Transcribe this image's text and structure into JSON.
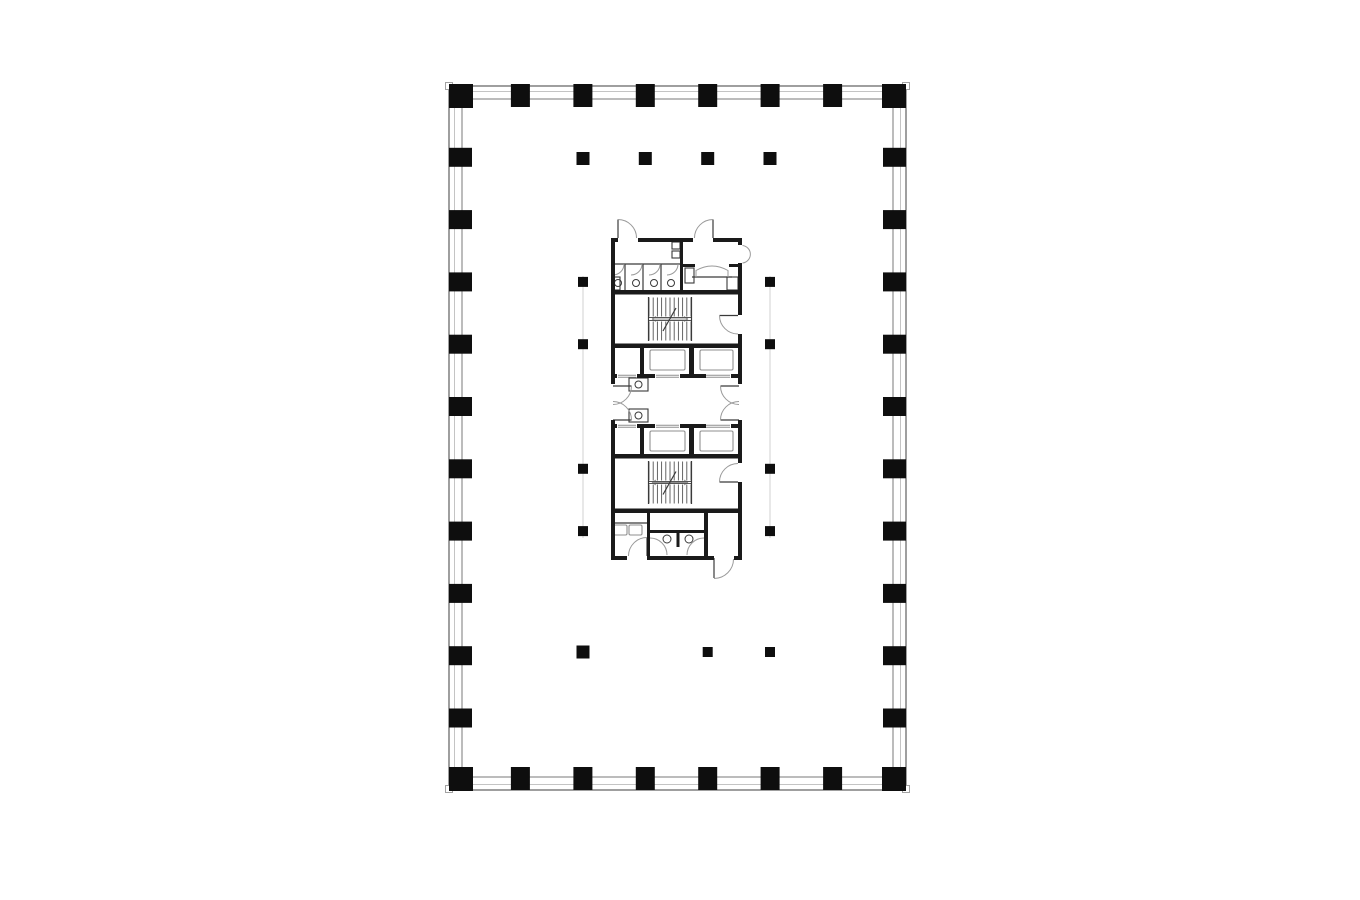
{
  "document": {
    "kind": "architectural-floor-plan",
    "description": "Typical tower floor plate: rectangular perimeter curtain wall with columns and a central service core (toilets, two stairs, four elevators, elevator lobby)",
    "text_labels": [],
    "background": "#ffffff"
  },
  "colors": {
    "ink": "#0e0e0e",
    "wall": "#1a1a1a",
    "thin": "#3a3a3a",
    "tread": "#555555",
    "light": "#8f8f8f",
    "arc": "#9a9a9a",
    "faint": "#d2d2d2",
    "band_outer": "#6b6b6b",
    "band_mid": "#c4c4c4",
    "band_inner": "#7a7a7a",
    "tick_stroke": "#999999",
    "paper": "#ffffff"
  },
  "canvas": {
    "width": 1360,
    "height": 900
  },
  "plan": {
    "band": {
      "outer": [
        449,
        86,
        457,
        704
      ],
      "mid": [
        454.5,
        91.5,
        446,
        693
      ],
      "inner": [
        462,
        99,
        431,
        678
      ]
    },
    "corner_ticks": [
      [
        445.5,
        82.5,
        7,
        7
      ],
      [
        902.5,
        82.5,
        7,
        7
      ],
      [
        445.5,
        785.5,
        7,
        7
      ],
      [
        902.5,
        785.5,
        7,
        7
      ]
    ],
    "perimeter_columns": {
      "corner_positions": [
        [
          449,
          84
        ],
        [
          882,
          84
        ],
        [
          449,
          767
        ],
        [
          882,
          767
        ]
      ],
      "corner_size": 24,
      "top_xs": [
        520.4,
        582.9,
        645.3,
        707.7,
        770.1,
        832.6
      ],
      "bottom_xs": [
        520.4,
        582.9,
        645.3,
        707.7,
        770.1,
        832.6
      ],
      "left_ys": [
        157.3,
        219.6,
        281.9,
        344.2,
        406.5,
        468.8,
        531.1,
        593.4,
        655.7,
        718
      ],
      "right_ys": [
        157.3,
        219.6,
        281.9,
        344.2,
        406.5,
        468.8,
        531.1,
        593.4,
        655.7,
        718
      ],
      "top_y": 84,
      "bottom_y": 767,
      "left_x": 449,
      "right_x": 883,
      "edge_w": 19,
      "edge_h": 23,
      "side_w": 23,
      "side_h": 19
    },
    "interior_columns": [
      [
        583,
        158.5,
        13
      ],
      [
        645.3,
        158.5,
        13
      ],
      [
        707.7,
        158.5,
        13
      ],
      [
        770,
        158.5,
        13
      ],
      [
        583,
        281.9,
        10
      ],
      [
        770,
        281.9,
        10
      ],
      [
        583,
        344.2,
        10
      ],
      [
        770,
        344.2,
        10
      ],
      [
        583,
        468.8,
        10
      ],
      [
        770,
        468.8,
        10
      ],
      [
        583,
        531.1,
        10
      ],
      [
        770,
        531.1,
        10
      ],
      [
        583,
        652,
        13
      ],
      [
        707.7,
        652,
        10
      ],
      [
        770,
        652,
        10
      ]
    ],
    "faint_lines": [
      [
        583,
        276,
        583,
        538
      ],
      [
        770,
        276,
        770,
        538
      ]
    ]
  },
  "core": {
    "wall_rects": [
      [
        611,
        238,
        7,
        4
      ],
      [
        638,
        238,
        55,
        4
      ],
      [
        713,
        238,
        29,
        4
      ],
      [
        611,
        238,
        4,
        146
      ],
      [
        611,
        420,
        4,
        140
      ],
      [
        738,
        238,
        4,
        7
      ],
      [
        738,
        263,
        4,
        52
      ],
      [
        738,
        334,
        4,
        50
      ],
      [
        738,
        420,
        4,
        43
      ],
      [
        738,
        482,
        4,
        78
      ],
      [
        680,
        238,
        3,
        53
      ],
      [
        683,
        264,
        12,
        3
      ],
      [
        729,
        264,
        9,
        3
      ],
      [
        611,
        290,
        131,
        4.5
      ],
      [
        611,
        343.5,
        131,
        4.5
      ],
      [
        640,
        348,
        4,
        26
      ],
      [
        689,
        348,
        5,
        26
      ],
      [
        611,
        374,
        6,
        4
      ],
      [
        637,
        374,
        18,
        4
      ],
      [
        680,
        374,
        26,
        4
      ],
      [
        731,
        374,
        11,
        4
      ],
      [
        611,
        424,
        6,
        4
      ],
      [
        637,
        424,
        18,
        4
      ],
      [
        680,
        424,
        26,
        4
      ],
      [
        731,
        424,
        11,
        4
      ],
      [
        640,
        428,
        4,
        26
      ],
      [
        689,
        428,
        5,
        26
      ],
      [
        611,
        454,
        131,
        4.5
      ],
      [
        611,
        508.5,
        131,
        4.5
      ],
      [
        647,
        513,
        3,
        43
      ],
      [
        704,
        513,
        4,
        43
      ],
      [
        650,
        530,
        54,
        3
      ],
      [
        676.5,
        533,
        3,
        14
      ],
      [
        611,
        556,
        16,
        4
      ],
      [
        647,
        556,
        67,
        4
      ],
      [
        734,
        556,
        8,
        4
      ]
    ],
    "thin_lines": [
      [
        611,
        264,
        680,
        264
      ],
      [
        625,
        264,
        625,
        290
      ],
      [
        643,
        264,
        643,
        290
      ],
      [
        661,
        264,
        661,
        290
      ],
      [
        648.5,
        297,
        648.5,
        341
      ],
      [
        691.5,
        297,
        691.5,
        341
      ],
      [
        648.5,
        461,
        648.5,
        504
      ],
      [
        691.5,
        461,
        691.5,
        504
      ],
      [
        611,
        523,
        647,
        523
      ],
      [
        692,
        277,
        732,
        277
      ],
      [
        663,
        331,
        676,
        308
      ],
      [
        663,
        494.5,
        676,
        471.5
      ]
    ],
    "thin_rects": [
      [
        612,
        277,
        8,
        13
      ],
      [
        672,
        242,
        8,
        7
      ],
      [
        672,
        251,
        8,
        7
      ],
      [
        727,
        277,
        11,
        13
      ],
      [
        685,
        268,
        9,
        15
      ],
      [
        629,
        378,
        19,
        13
      ],
      [
        629,
        409,
        19,
        13
      ]
    ],
    "light_rects": [
      [
        650,
        350,
        35,
        20
      ],
      [
        700,
        350,
        33,
        20
      ],
      [
        650,
        431,
        35,
        20
      ],
      [
        700,
        431,
        33,
        20
      ],
      [
        614,
        525,
        13,
        10
      ],
      [
        629,
        525,
        13,
        10
      ]
    ],
    "light_lines": [
      [
        656,
        375.3,
        679,
        375.3
      ],
      [
        656,
        377.2,
        679,
        377.2
      ],
      [
        706,
        375.3,
        730,
        375.3
      ],
      [
        706,
        377.2,
        730,
        377.2
      ],
      [
        618,
        375.3,
        636,
        375.3
      ],
      [
        618,
        377.2,
        636,
        377.2
      ],
      [
        656,
        425.3,
        679,
        425.3
      ],
      [
        656,
        427.2,
        679,
        427.2
      ],
      [
        706,
        425.3,
        730,
        425.3
      ],
      [
        706,
        427.2,
        730,
        427.2
      ],
      [
        618,
        425.3,
        636,
        425.3
      ],
      [
        618,
        427.2,
        636,
        427.2
      ],
      [
        652,
        319,
        688,
        319
      ],
      [
        652,
        319,
        656,
        316.5
      ],
      [
        652,
        319,
        656,
        321.5
      ],
      [
        688,
        319,
        684,
        316.5
      ],
      [
        688,
        319,
        684,
        321.5
      ],
      [
        652,
        482.5,
        688,
        482.5
      ],
      [
        652,
        482.5,
        656,
        480
      ],
      [
        652,
        482.5,
        656,
        485
      ],
      [
        688,
        482.5,
        684,
        480
      ],
      [
        688,
        482.5,
        684,
        485
      ]
    ],
    "door_leaves": [
      [
        618,
        238,
        618,
        219.5
      ],
      [
        713,
        238,
        713,
        219.5
      ],
      [
        738,
        315.5,
        719.5,
        315.5
      ],
      [
        613,
        386,
        631.5,
        386
      ],
      [
        613,
        420,
        631.5,
        420
      ],
      [
        739,
        386,
        720.5,
        386
      ],
      [
        739,
        420,
        720.5,
        420
      ],
      [
        738,
        482,
        719.5,
        482
      ],
      [
        647,
        556,
        647,
        537.5
      ],
      [
        714,
        558,
        714,
        578
      ]
    ],
    "door_arcs": [
      "M 618,219.5 A 18.5,18.5 0 0 1 636.5,238",
      "M 713,219.5 A 18.5,18.5 0 0 0 694.5,238",
      "M 742.5,245.5 A 8.8,8.8 0 0 1 742.5,263",
      "M 719.5,315.5 A 18.5,18.5 0 0 0 738,334",
      "M 631.5,386 A 18.5,18.5 0 0 1 613,404.5",
      "M 631.5,420 A 18.5,18.5 0 0 0 613,401.5",
      "M 720.5,386 A 18.5,18.5 0 0 0 739,404.5",
      "M 720.5,420 A 18.5,18.5 0 0 1 739,401.5",
      "M 719.5,482 A 18.5,18.5 0 0 1 738,463.5",
      "M 647,537.5 A 18.5,18.5 0 0 0 628.5,556",
      "M 714,578.5 A 19.5,19.5 0 0 0 733.5,559",
      "M 650,538 A 17,17 0 0 1 667,555",
      "M 704,538 A 17,17 0 0 0 687,555",
      "M 624,264 A 11,11 0 0 1 613,275",
      "M 642,264 A 11,11 0 0 1 631,275",
      "M 660,264 A 11,11 0 0 1 649,275",
      "M 678,264 A 11,11 0 0 1 667,275",
      "M 696,277 L 696,270.5 Q 712,261.5 728,270.5 L 728,277"
    ],
    "circles": [
      [
        618,
        283,
        3.5
      ],
      [
        636,
        283,
        3.5
      ],
      [
        654,
        283,
        3.5
      ],
      [
        671,
        283,
        3.5
      ],
      [
        638.5,
        384.5,
        3.5
      ],
      [
        638.5,
        415.5,
        3.5
      ],
      [
        667,
        539,
        4
      ],
      [
        689,
        539,
        4
      ]
    ],
    "stairs": [
      {
        "x0": 649,
        "x1": 691,
        "n": 11,
        "bands": [
          [
            297.5,
            316.5
          ],
          [
            321.5,
            340.5
          ]
        ],
        "land": [
          317.5,
          320.5
        ]
      },
      {
        "x0": 649,
        "x1": 691,
        "n": 11,
        "bands": [
          [
            461.5,
            480.5
          ],
          [
            484.5,
            503.5
          ]
        ],
        "land": [
          481.5,
          483.5
        ]
      }
    ]
  }
}
